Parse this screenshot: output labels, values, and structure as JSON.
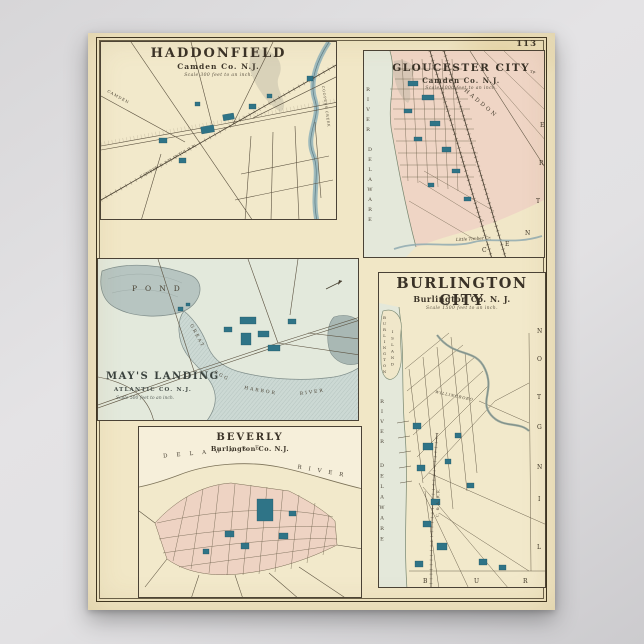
{
  "page": {
    "number": "113"
  },
  "colors": {
    "paper": "#f1e7c6",
    "ink": "#3c342a",
    "city_pink": "#efd5c5",
    "water_aqua": "#e3e9dc",
    "pond_gray": "#b7c5c1",
    "building_teal": "#2f7487"
  },
  "maps": {
    "haddonfield": {
      "title": "HADDONFIELD",
      "subtitle": "Camden Co. N.J.",
      "scale_note": "Scale 300 feet to an inch.",
      "labels": {
        "road_camden": "CAMDEN",
        "railroad": "CAMDEN & ATLANTIC R.R.",
        "creek": "COOPERS CREEK"
      }
    },
    "gloucester_city": {
      "title": "GLOUCESTER CITY",
      "subtitle": "Camden Co. N.J.",
      "scale_note": "Scale 1000 feet to an inch.",
      "labels": {
        "river_upper": "RIVER",
        "river_lower": "DELAWARE",
        "haddon": "HADDON",
        "township_abbr": "Tp.",
        "creek": "Little Timber Cr."
      },
      "border_letters": [
        "C",
        "E",
        "N",
        "T",
        "R",
        "E"
      ]
    },
    "mays_landing": {
      "title": "MAY'S LANDING",
      "subtitle": "ATLANTIC CO. N.J.",
      "scale_note": "Scale 500 feet to an inch.",
      "labels": {
        "pond": "POND",
        "river_1": "GREAT",
        "river_2": "EGG",
        "river_3": "HARBOR",
        "river_4": "RIVER"
      }
    },
    "burlington_city": {
      "title": "BURLINGTON CITY",
      "subtitle": "Burlington Co. N. J.",
      "scale_note": "Scale 1500 feet to an inch.",
      "labels": {
        "island_line1": "BURLINGTON",
        "island_line2": "ISLAND",
        "river_upper": "RIVER",
        "river_lower": "DELAWARE",
        "road": "WILLINGBORO",
        "railroad": "C. & A. R.R."
      },
      "border_bottom_letters": [
        "B",
        "U",
        "R"
      ],
      "border_right_letters": [
        "N",
        "O",
        "T",
        "G",
        "N",
        "I",
        "L"
      ]
    },
    "beverly": {
      "title": "BEVERLY",
      "subtitle": "Burlington Co. N.J.",
      "labels": {
        "river_word1": "DELAWARE",
        "river_word2": "RIVER"
      }
    }
  }
}
